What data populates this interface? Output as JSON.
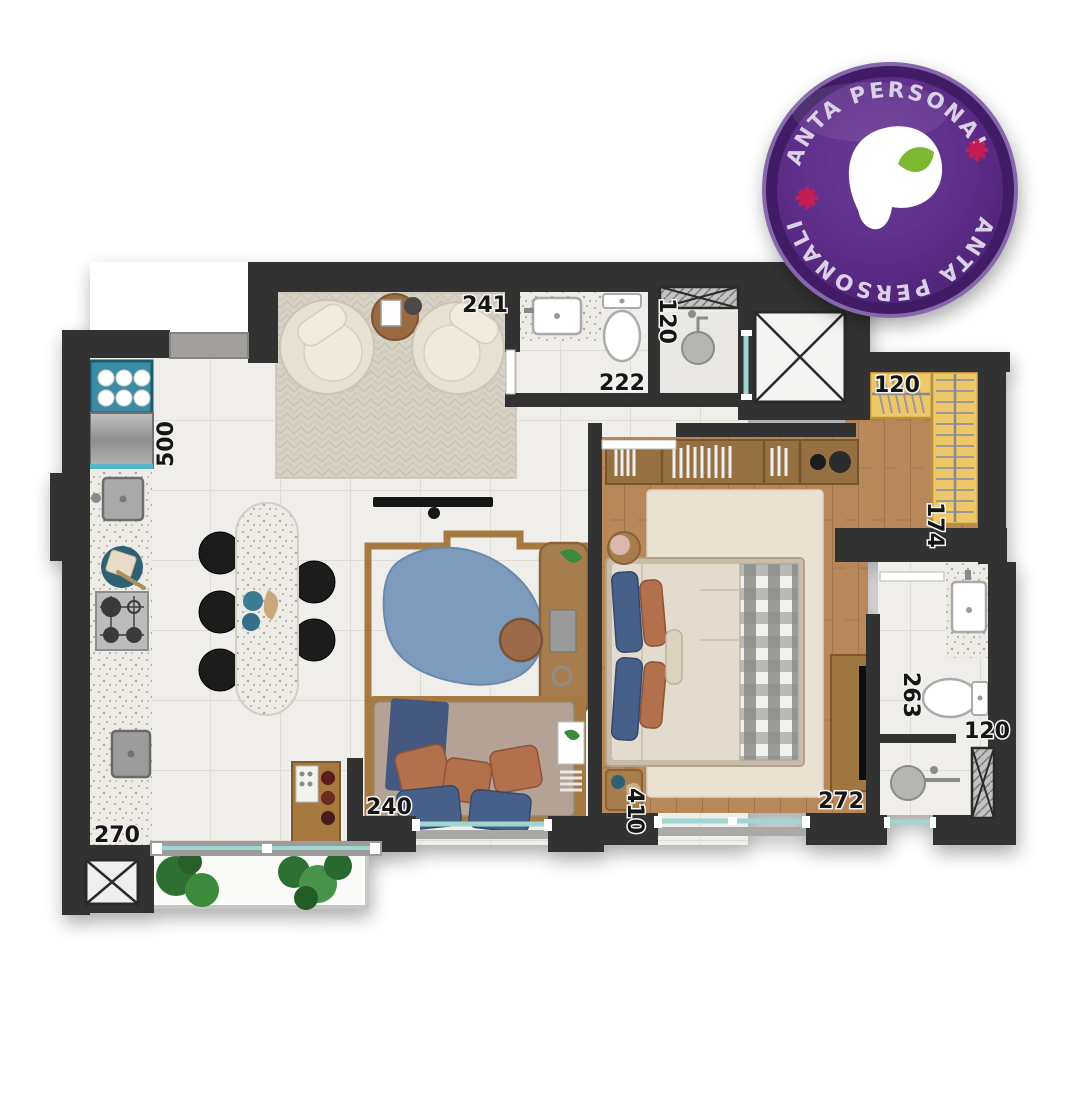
{
  "badge": {
    "arc_text_top": "PLANTA PERSONALIZE",
    "arc_text_bottom": "PLANTA PERSONALIZE",
    "colors": {
      "disc": "#5b2c86",
      "rim": "#3f1f66",
      "edge": "#8568ab",
      "text": "#d9d2e6",
      "logo": "#ffffff",
      "leaf": "#7cb832",
      "flower": "#c51f56"
    }
  },
  "floorplan": {
    "colors": {
      "wall": "#333333",
      "tile": "#f0eeea",
      "wood": "#b8875a",
      "wardrobe": "#eec768",
      "glass": "#9fd6d2",
      "rug_living": "#d8d2c7",
      "rug_office": "#7d9cbd",
      "kitchen_cabinet": "#3e8ca6",
      "plant": "#2f7031"
    },
    "labels": {
      "living_front": "241",
      "bath1_width": "120",
      "bath1_length": "222",
      "kitchen_run": "500",
      "service_width": "270",
      "office_width": "240",
      "office_depth": "410",
      "bedroom_front": "272",
      "bath2_length": "263",
      "bath2_width": "120",
      "closet_width": "120",
      "closet_depth": "174"
    }
  }
}
